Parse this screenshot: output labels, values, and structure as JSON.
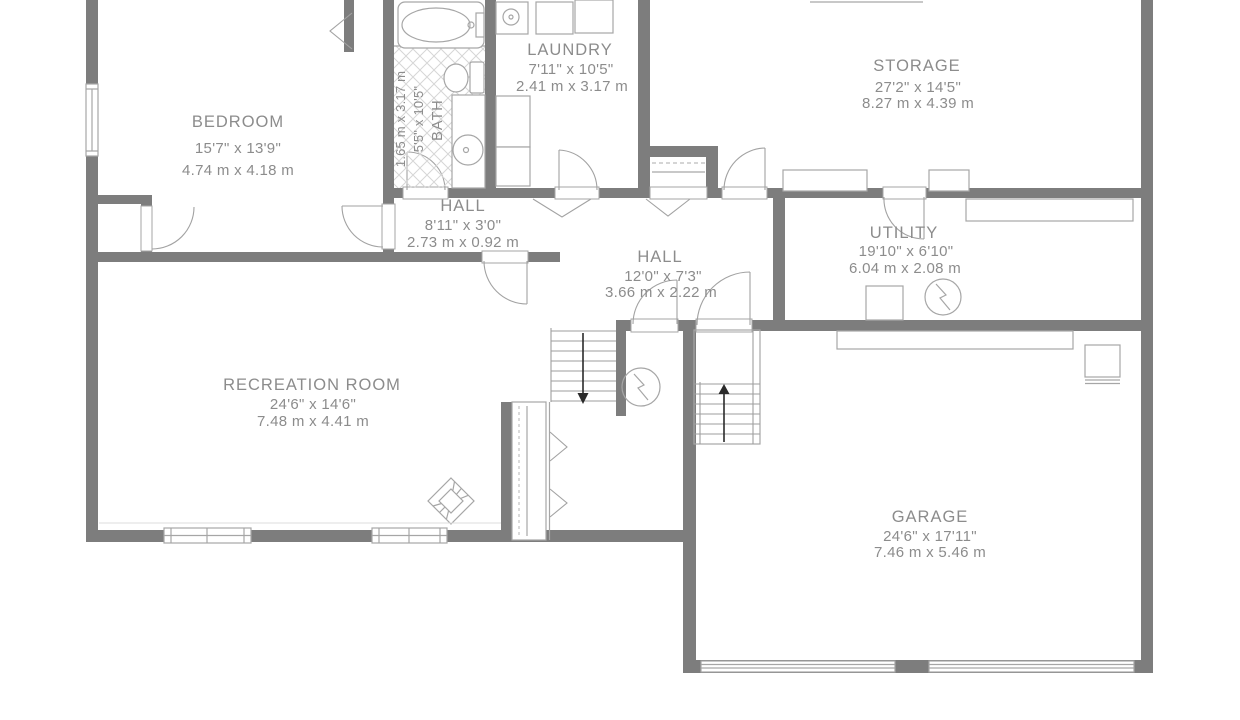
{
  "floorplan": {
    "rooms": {
      "bedroom": {
        "name": "BEDROOM",
        "imperial": "15'7\" x 13'9\"",
        "metric": "4.74 m x 4.18 m"
      },
      "bath": {
        "name": "BATH",
        "imperial": "5'5\" x 10'5\"",
        "metric": "1.65 m x 3.17 m"
      },
      "laundry": {
        "name": "LAUNDRY",
        "imperial": "7'11\" x 10'5\"",
        "metric": "2.41 m x 3.17 m"
      },
      "storage": {
        "name": "STORAGE",
        "imperial": "27'2\" x 14'5\"",
        "metric": "8.27 m x 4.39 m"
      },
      "hall_upper": {
        "name": "HALL",
        "imperial": "8'11\" x 3'0\"",
        "metric": "2.73 m x 0.92 m"
      },
      "hall_lower": {
        "name": "HALL",
        "imperial": "12'0\" x 7'3\"",
        "metric": "3.66 m x 2.22 m"
      },
      "utility": {
        "name": "UTILITY",
        "imperial": "19'10\" x 6'10\"",
        "metric": "6.04 m x 2.08 m"
      },
      "recreation": {
        "name": "RECREATION ROOM",
        "imperial": "24'6\" x 14'6\"",
        "metric": "7.48 m x 4.41 m"
      },
      "garage": {
        "name": "GARAGE",
        "imperial": "24'6\" x 17'11\"",
        "metric": "7.46 m x 5.46 m"
      }
    },
    "colors": {
      "wall": "#7d7d7d",
      "label": "#8c8c8c",
      "fixture": "#a6a6a6"
    }
  }
}
